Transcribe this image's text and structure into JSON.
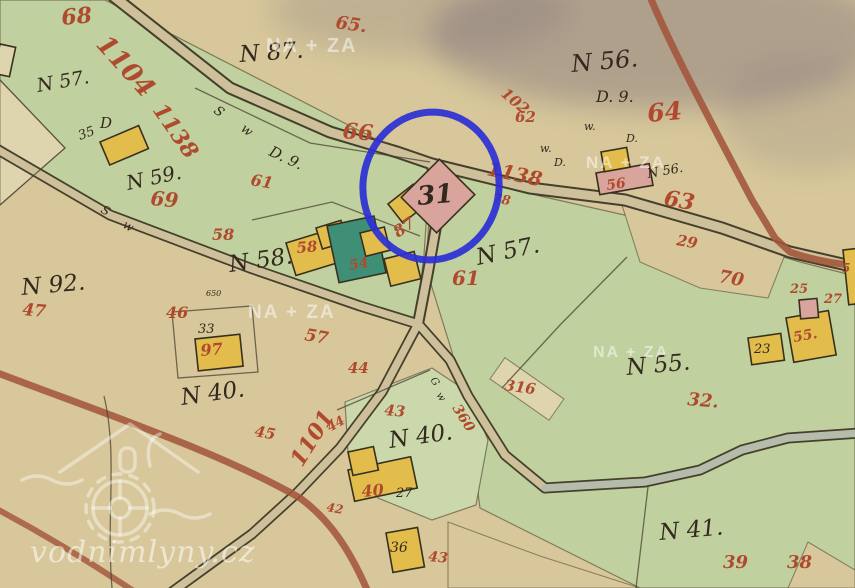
{
  "map_type": "historical-cadastral-map",
  "colors": {
    "paper": "#d7c79a",
    "paper_light": "#ded4ad",
    "field_green": "#c0d09e",
    "field_green2": "#cbd8ab",
    "road_fill": "#cdc09a",
    "road_casing": "#45402c",
    "road_red": "#a2543a",
    "channel": "#b6bcab",
    "ink": "#33291e",
    "red_ink": "#b04a2f",
    "wood_building": "#e2bd4c",
    "stone_building": "#d9a49c",
    "special_building": "#3f8f77",
    "annotation_blue": "#2b2fd6",
    "smudge": "#6f6377"
  },
  "ink": [
    "N 57.",
    "D",
    "N 87.",
    "S",
    "w",
    "D. 9.",
    "N 56.",
    "D. 9.",
    "w.",
    "D.",
    "w.",
    "D.",
    "N 56.",
    "N 59.",
    "S",
    "w",
    "N 92.",
    "N 58.",
    "N 57.",
    "N 40.",
    "N 40.",
    "N 55.",
    "N 41.",
    "33",
    "35",
    "650",
    "G",
    "w",
    "27",
    "36",
    "23",
    "31"
  ],
  "red": [
    "68",
    "65.",
    "1104",
    "1138",
    "66.",
    "61",
    "69",
    "58",
    "102",
    "62",
    "64",
    "1138",
    "78",
    "56",
    "63",
    "29",
    "70",
    "25",
    "27",
    "55.",
    "58",
    "54",
    "87",
    "61",
    "57",
    "46",
    "97",
    "47",
    "44",
    "45",
    "1101",
    "44",
    "360",
    "43",
    "40",
    "42",
    "43",
    "316",
    "32.",
    "39",
    "38",
    "5"
  ],
  "watermark": {
    "site": "vodnimlyny.cz",
    "tags": [
      "NA + ZA",
      "NA + ZA",
      "NA + ZA",
      "NA + ZA"
    ]
  },
  "annotation": {
    "highlighted_label": "31",
    "color": "#2b2fd6"
  }
}
